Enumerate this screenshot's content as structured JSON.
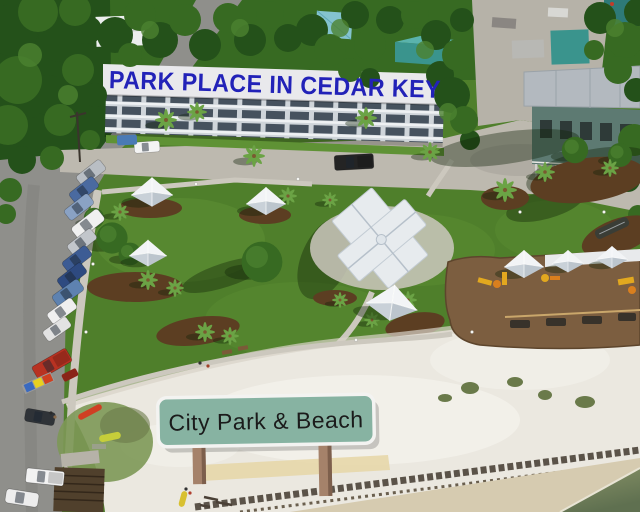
{
  "banner": {
    "text": "PARK PLACE IN CEDAR KEY",
    "text_color": "#2222b8",
    "panel_color": "#e9e9ec"
  },
  "beach_sign": {
    "text": "City Park & Beach",
    "text_color": "#1b1b1b",
    "panel_color": "#87b3a2",
    "border_color": "#f3f3f1",
    "post_color": "#a5826a",
    "post_edge": "#7d5f4c"
  },
  "palette": {
    "grass": "#4f7f2b",
    "grass_light": "#5f9235",
    "tree_shadow": "rgba(15,35,8,0.38)",
    "canopy": "#376a22",
    "canopy_dark": "#24511a",
    "canopy_light": "#4c8230",
    "palm": "#6ba345",
    "asphalt": "#8f8f8b",
    "concrete": "#bdb9af",
    "concrete_light": "#b6b2a8",
    "path": "#ccc8be",
    "sand": "#ebe8e0",
    "sand_shade": "#d8d3c8",
    "sand_bright": "#f6f4ee",
    "wet_sand": "#d6cbb0",
    "tan_path": "#e6d6a6",
    "water_edge": "#8a9468",
    "water_deep": "#5f7050",
    "wrack": "#4b4338",
    "mulch": "#5c3e22",
    "playground": "#7c5e40",
    "roof_white": "#e7ebee",
    "roof_teal": "#3a948d",
    "roof_teal_light": "#5ab3ac",
    "roof_ltblue": "#84c3cf",
    "roof_gray": "#b3b9bf",
    "condo_face": "#cfd5da",
    "condo_window": "#46525e",
    "condo_rail": "#eef1f3",
    "equip_yellow": "#e2a81f",
    "equip_orange": "#d97f1e",
    "frame_tan": "#caa76b",
    "bench_dark": "#38322a",
    "shelter_light": "#f2f4f6",
    "shelter_shade": "#c9d1d8",
    "grass_patch": "#7d9857",
    "shrub": "#6a7a4a"
  },
  "street": {
    "vehicles": [
      {
        "color": "#b9bec4"
      },
      {
        "color": "#4a6aa0"
      },
      {
        "color": "#8aa2c4"
      },
      {
        "color": "#f0f0f0"
      },
      {
        "color": "#c2c6cb"
      },
      {
        "color": "#3d5c94"
      },
      {
        "color": "#2e4a80"
      },
      {
        "color": "#5e82b0"
      },
      {
        "color": "#efefef"
      },
      {
        "color": "#e2e2e2"
      },
      {
        "color": "#b83222"
      },
      {
        "color": "#2f3338"
      },
      {
        "color": "#f2f2f2"
      },
      {
        "color": "#ededed"
      },
      {
        "color": "#242424"
      },
      {
        "color": "#f4f4f4"
      }
    ],
    "kayak_trailer": [
      "#3a6ac0",
      "#e8d020",
      "#cf4020"
    ],
    "kayaks": {
      "red": "#cf3f23",
      "yellow": "#c6ce3a",
      "small": "#d8c030"
    }
  }
}
